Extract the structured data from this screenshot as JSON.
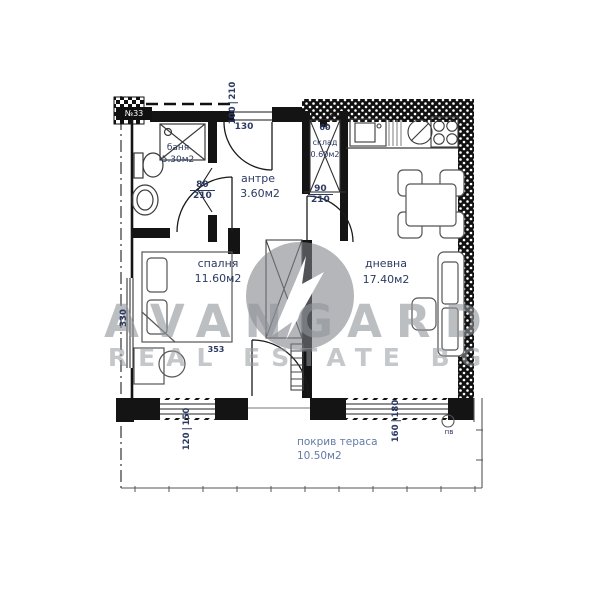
{
  "meta": {
    "drawing": "apartment floor plan"
  },
  "watermark": {
    "brand": "AVANGARD",
    "tagline": "REAL ESTATE BG",
    "logo": "avangard-circle-logo"
  },
  "unit": {
    "number": "№33"
  },
  "rooms": {
    "bath": {
      "name": "баня",
      "area": "5.30м2"
    },
    "hall": {
      "name": "антре",
      "area": "3.60м2"
    },
    "storage": {
      "name": "склад",
      "area": "0.60м2"
    },
    "bedroom": {
      "name": "спалня",
      "area": "11.60м2"
    },
    "living": {
      "name": "дневна",
      "area": "17.40м2"
    },
    "terrace": {
      "name": "покрив тераса",
      "area": "10.50м2"
    }
  },
  "dims": {
    "entry_offset": "130",
    "entry_door": {
      "w": "100",
      "h": "210"
    },
    "bedroom_door": {
      "w": "80",
      "h": "210"
    },
    "living_door": {
      "w": "90",
      "h": "210"
    },
    "storage_w": "60",
    "bedroom_w": "330",
    "bedroom_l": "353",
    "window_left": {
      "w": "120",
      "h": "150"
    },
    "window_right": {
      "w": "160",
      "h": "180"
    }
  },
  "symbols": {
    "shaft": "КЛ",
    "vent": "пв",
    "boiler": "✳"
  },
  "colors": {
    "wall": "#141414",
    "dimension_text": "#2c3a63",
    "terrace_text": "#647ba8",
    "watermark_gray": "#9aa0a6"
  }
}
